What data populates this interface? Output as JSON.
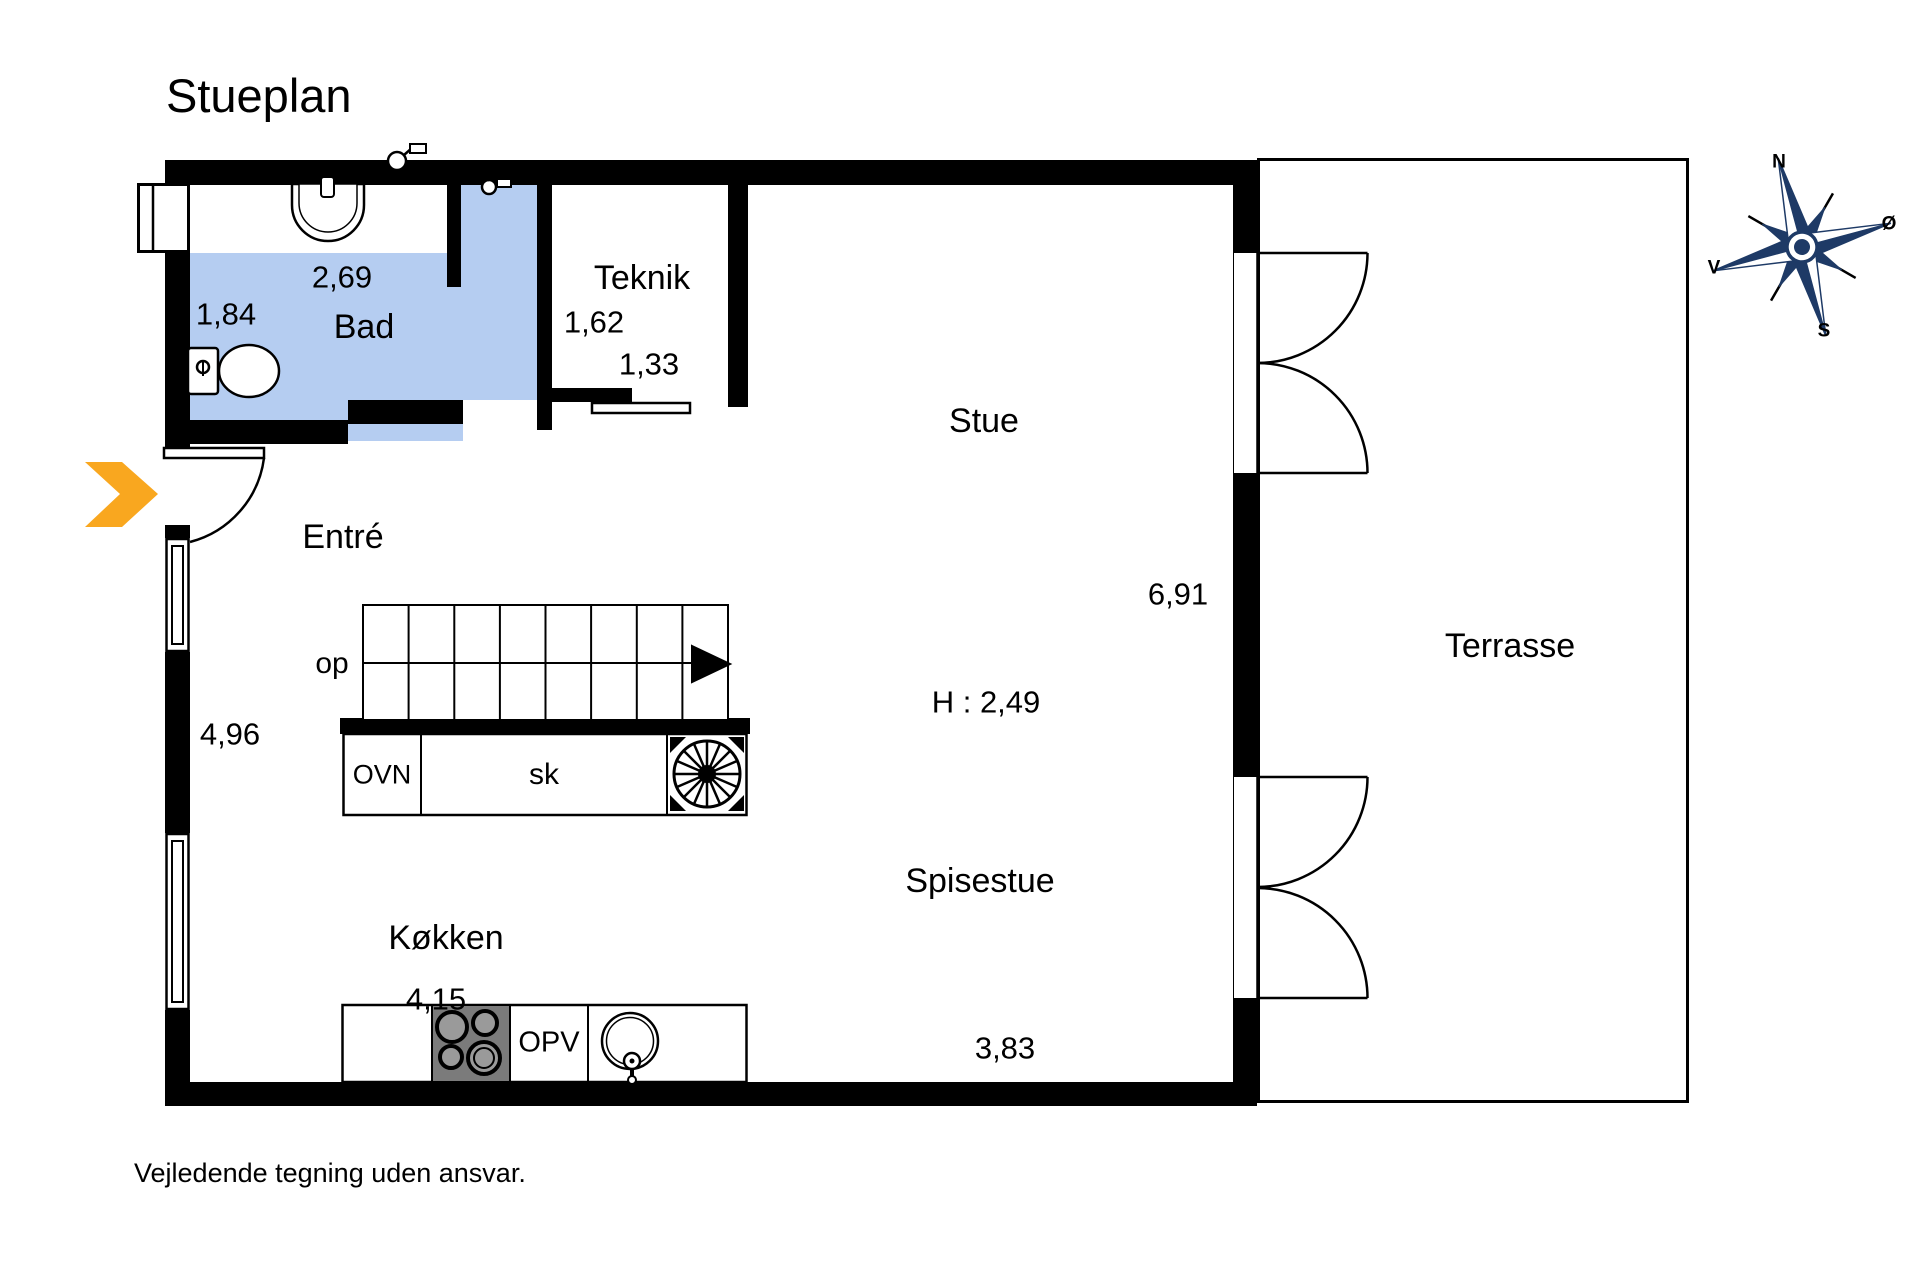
{
  "page": {
    "title": "Stueplan",
    "disclaimer": "Vejledende tegning uden ansvar."
  },
  "rooms": {
    "bad": {
      "label": "Bad",
      "width": "2,69",
      "depth": "1,84"
    },
    "teknik": {
      "label": "Teknik",
      "dim1": "1,62",
      "dim2": "1,33"
    },
    "entre": {
      "label": "Entré",
      "wall_length": "4,96"
    },
    "stue": {
      "label": "Stue",
      "length": "6,91",
      "ceiling_height": "H : 2,49"
    },
    "spisestue": {
      "label": "Spisestue",
      "width": "3,83"
    },
    "kokken": {
      "label": "Køkken",
      "width": "4,15"
    },
    "terrasse": {
      "label": "Terrasse"
    }
  },
  "stairs": {
    "direction_label": "op"
  },
  "kitchen_units": {
    "oven": "OVN",
    "cabinet": "sk",
    "dishwasher": "OPV"
  },
  "compass": {
    "n": "N",
    "e": "Ø",
    "s": "S",
    "v": "V"
  },
  "colors": {
    "bathroom_fill": "#b5cdf1",
    "entry_arrow": "#f9a71f",
    "compass_navy": "#1e3a66"
  }
}
